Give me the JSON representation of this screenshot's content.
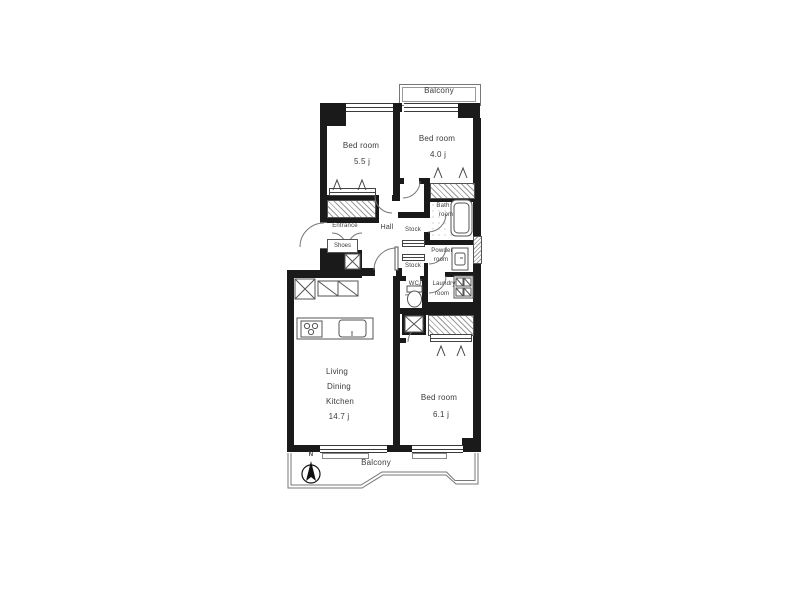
{
  "colors": {
    "wall": "#1a1a1a",
    "line": "#666",
    "text": "#3b3b3b"
  },
  "rooms": {
    "balcony_top": {
      "label": "Balcony"
    },
    "bedroom1": {
      "label": "Bed room",
      "size": "5.5 j"
    },
    "bedroom2": {
      "label": "Bed room",
      "size": "4.0 j"
    },
    "bathroom": {
      "line1": "Bath",
      "line2": "room"
    },
    "entrance": {
      "label": "Entrance"
    },
    "shoes": {
      "label": "Shoes"
    },
    "hall": {
      "label": "Hall"
    },
    "stock1": {
      "label": "Stock"
    },
    "stock2": {
      "label": "Stock"
    },
    "powder": {
      "line1": "Powder",
      "line2": "room"
    },
    "wc": {
      "label": "WC"
    },
    "laundry": {
      "line1": "Laundry",
      "line2": "room"
    },
    "ldk": {
      "line1": "Living",
      "line2": "Dining",
      "line3": "Kitchen",
      "size": "14.7 j"
    },
    "bedroom3": {
      "label": "Bed room",
      "size": "6.1 j"
    },
    "balcony_bottom": {
      "label": "Balcony"
    },
    "compass": {
      "label": "N"
    }
  }
}
